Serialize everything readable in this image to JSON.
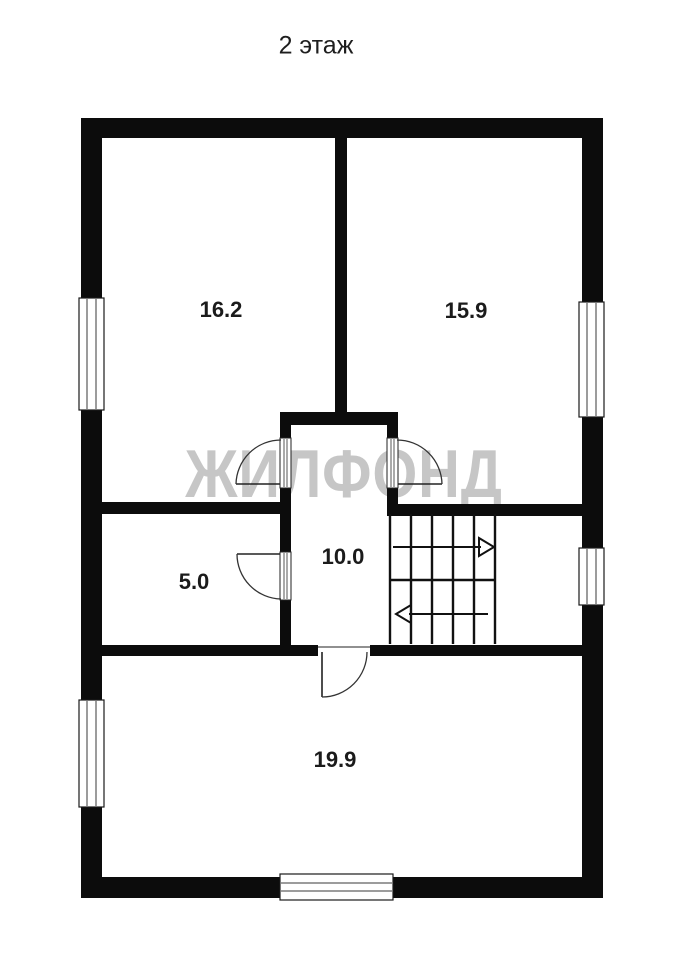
{
  "title": "2 этаж",
  "watermark": "ЖИЛФОНД",
  "floor_plan": {
    "rooms": [
      {
        "id": "room-top-left",
        "area_label": "16.2"
      },
      {
        "id": "room-top-right",
        "area_label": "15.9"
      },
      {
        "id": "room-mid-left",
        "area_label": "5.0"
      },
      {
        "id": "hallway-center",
        "area_label": "10.0"
      },
      {
        "id": "room-bottom",
        "area_label": "19.9"
      }
    ],
    "stairs": {
      "flights": 2,
      "up_arrow_direction": "right",
      "down_arrow_direction": "left"
    },
    "windows_count": 5,
    "door_arcs_count": 4
  },
  "colors": {
    "wall": "#0c0c0c",
    "watermark": "#c6c6c6",
    "label_text": "#1b1b1b",
    "background": "#ffffff"
  }
}
